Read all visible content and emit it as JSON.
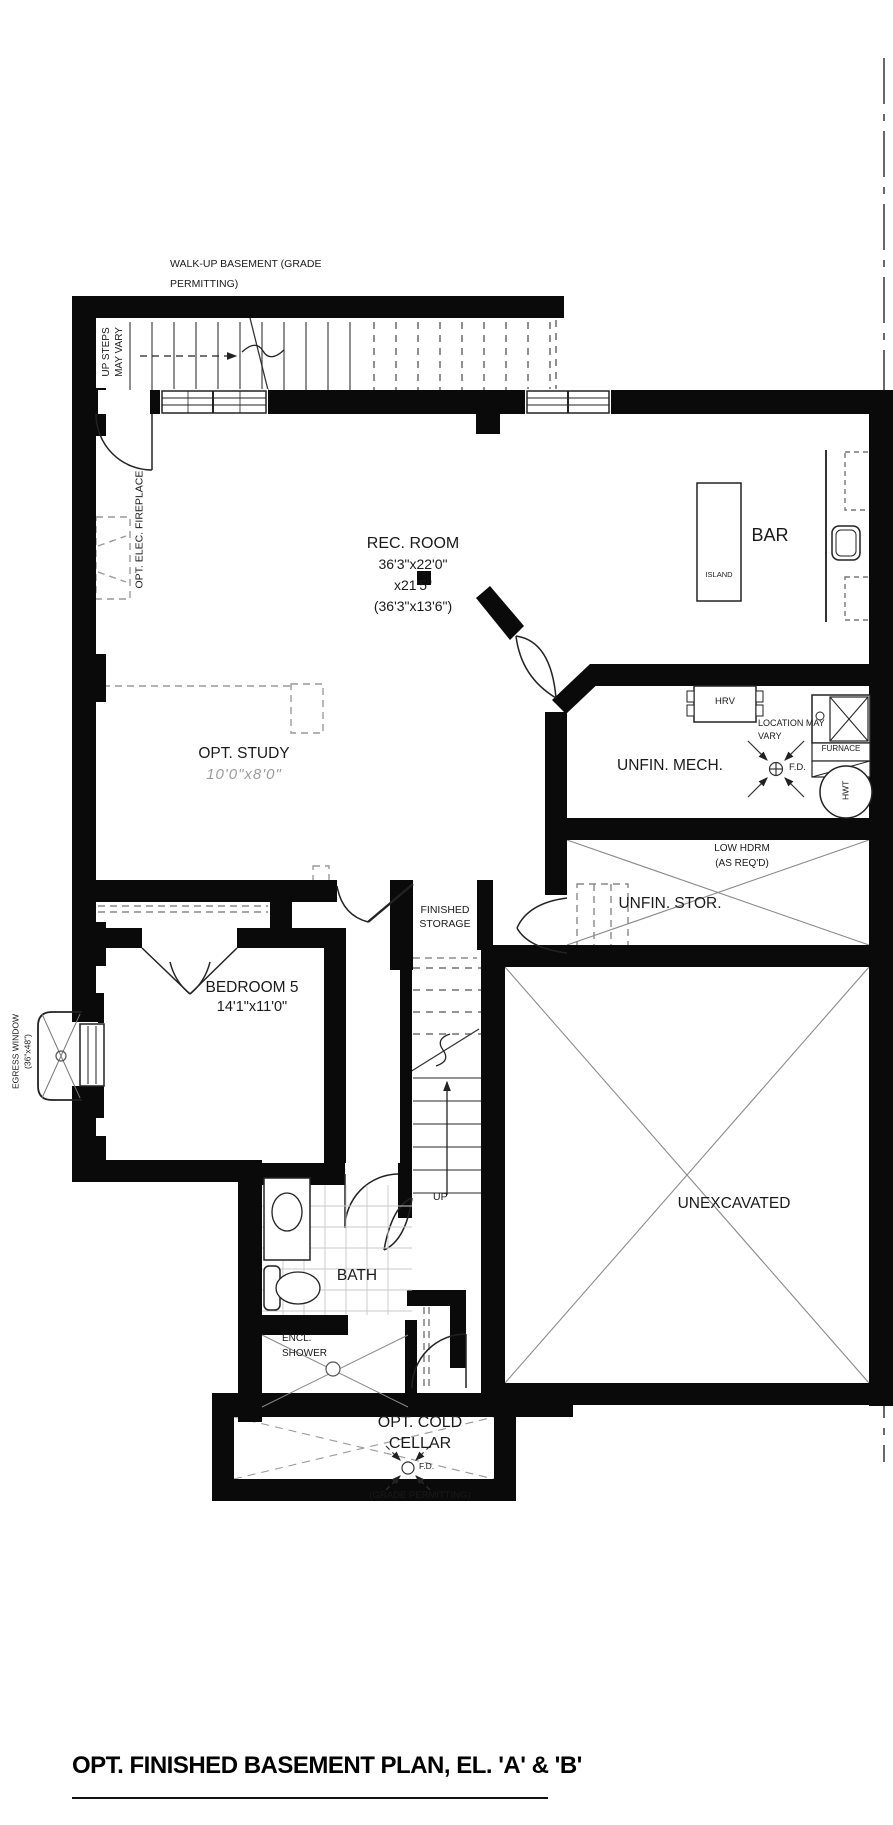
{
  "page": {
    "title_block": "OPT. FINISHED BASEMENT PLAN, EL. 'A' & 'B'"
  },
  "labels": {
    "walkup_note": "WALK-UP BASEMENT (GRADE\nPERMITTING)",
    "up_steps_note": "UP STEPS\nMAY VARY",
    "fireplace_note": "OPT. ELEC. FIREPLACE",
    "egress_note": "EGRESS WINDOW\n(36\"x48\")",
    "up_label": "UP",
    "low_hdrm_note": "LOW HDRM\n(AS REQ'D)",
    "location_note": "LOCATION MAY\nVARY",
    "fd_label": "F.D.",
    "fd_label_cellar": "F.D.",
    "grade_note": "(GRADE PERMITTING)"
  },
  "rooms": {
    "rec_room": {
      "name": "REC. ROOM",
      "dims": "36'3\"x22'0\"\nx21'5\"\n(36'3\"x13'6\")"
    },
    "bar": "BAR",
    "island": "ISLAND",
    "study": {
      "name": "OPT. STUDY",
      "dims": "10'0\"x8'0\""
    },
    "mech": "UNFIN. MECH.",
    "stor": "UNFIN. STOR.",
    "finished_storage": "FINISHED\nSTORAGE",
    "bedroom": {
      "name": "BEDROOM 5",
      "dims": "14'1\"x11'0\""
    },
    "unexcavated": "UNEXCAVATED",
    "bath": "BATH",
    "shower": "ENCL.\nSHOWER",
    "cold_cellar": "OPT. COLD\nCELLAR"
  },
  "equipment": {
    "hrv": "HRV",
    "furnace": "FURNACE",
    "hwt": "HWT"
  }
}
